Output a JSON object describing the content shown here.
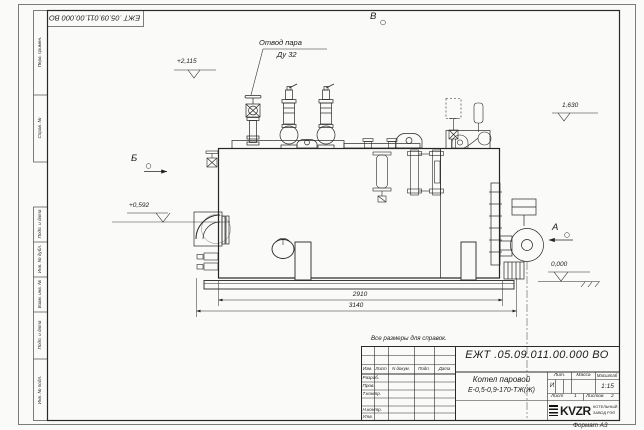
{
  "page": {
    "note": "Все размеры для справок.",
    "format": "Формат А3"
  },
  "stamp": {
    "designation": "ЕЖТ .05.09.011.00.000 ВО"
  },
  "margin_labels": {
    "perv": "Перв. примен.",
    "sprav": "Справ. №",
    "podp1": "Подп. и дата",
    "inv_dubl": "Инв. № дубл.",
    "vzam": "Взам. инв. №",
    "podp2": "Подп. и дата",
    "inv_podl": "Инв. № подл."
  },
  "drawing": {
    "callout": {
      "line1": "Отвод пара",
      "line2": "Ду 32"
    },
    "views": {
      "top": "В",
      "left": "Б",
      "right": "А"
    },
    "elevations": {
      "top": "+2,115",
      "right": "1,630",
      "left": "+0,592",
      "zero": "0,000"
    },
    "dimensions": {
      "inner": "2910",
      "overall": "3140"
    }
  },
  "title_block": {
    "designation": "ЕЖТ .05.09.011.00.000 ВО",
    "product_name_line1": "Котел паровой",
    "product_name_line2": "Е-0,5-0,9-170-ТЖ(Ж)",
    "col_izm": "Изм.",
    "col_list": "Лист",
    "col_doc": "N докум.",
    "col_podp": "Подп.",
    "col_data": "Дата",
    "row_razrab": "Разраб.",
    "row_prov": "Пров.",
    "row_tkontr": "Т.контр.",
    "row_nkontr": "Н.контр.",
    "row_utv": "Утв.",
    "lit_header": "Лит.",
    "mass_header": "Масса",
    "scale_header": "Масштаб",
    "litera": "И",
    "scale": "1:15",
    "sheet_label": "Лист",
    "sheet_value": "1",
    "sheets_label": "Листов",
    "sheets_value": "2",
    "logo_text": "KVZR",
    "company_line1": "КОТЕЛЬНЫЙ",
    "company_line2": "ЗАВОД РЭП"
  }
}
